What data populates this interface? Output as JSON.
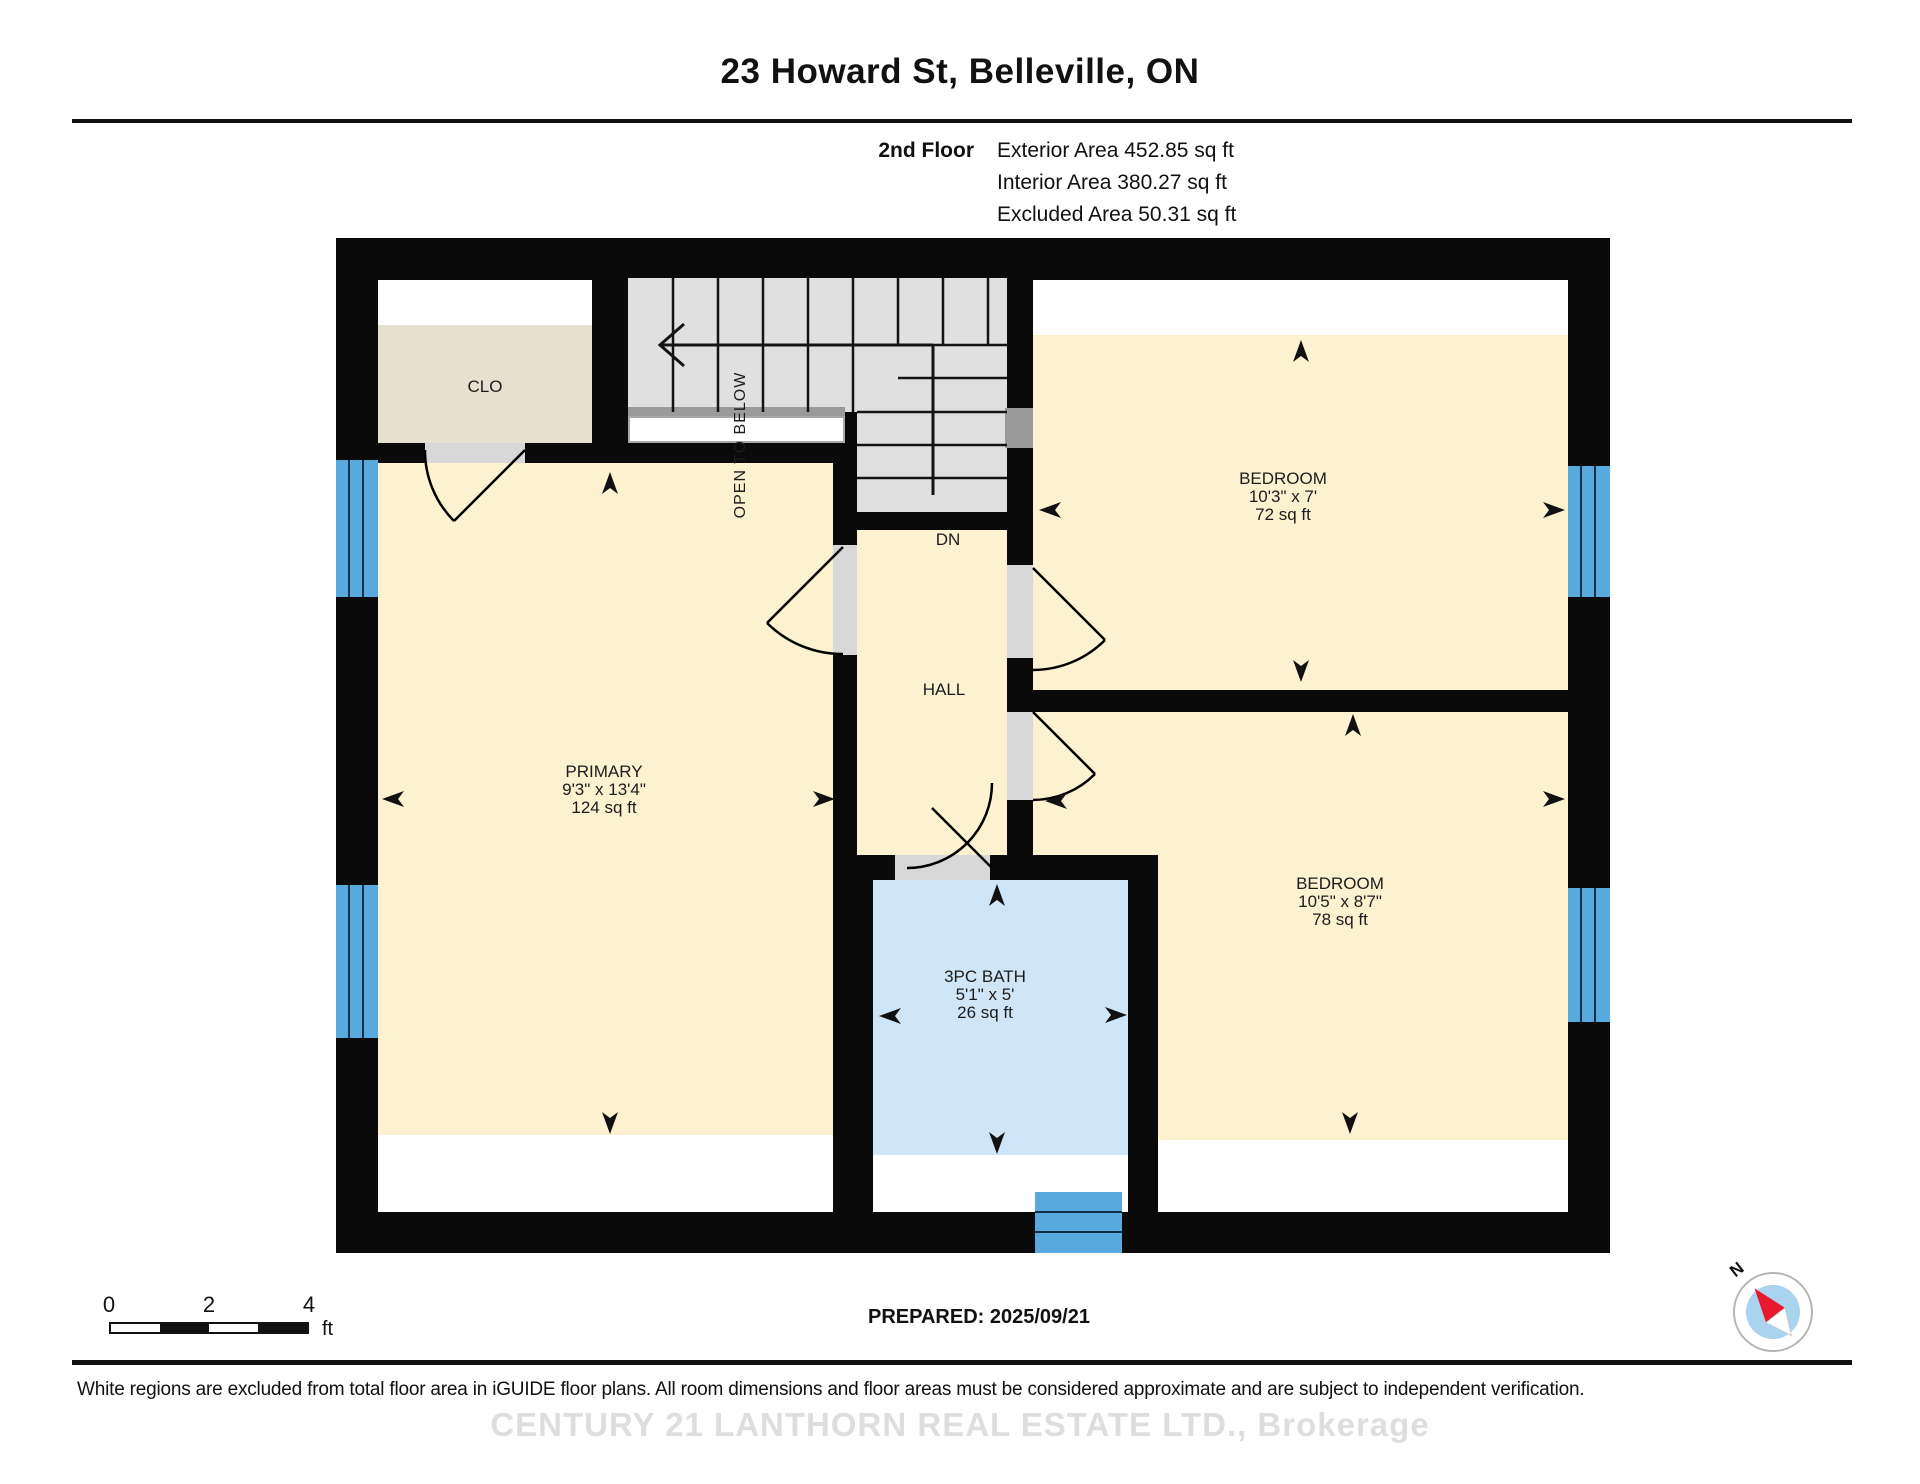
{
  "header": {
    "title": "23 Howard St, Belleville, ON",
    "floor_label": "2nd Floor",
    "areas": [
      "Exterior Area 452.85 sq ft",
      "Interior Area 380.27 sq ft",
      "Excluded Area 50.31 sq ft"
    ]
  },
  "rooms": {
    "closet": {
      "name": "CLO"
    },
    "primary": {
      "name": "PRIMARY",
      "dims": "9'3\" x 13'4\"",
      "area": "124 sq ft"
    },
    "bedroom_top": {
      "name": "BEDROOM",
      "dims": "10'3\" x 7'",
      "area": "72 sq ft"
    },
    "bedroom_bottom": {
      "name": "BEDROOM",
      "dims": "10'5\" x 8'7\"",
      "area": "78 sq ft"
    },
    "bath": {
      "name": "3PC BATH",
      "dims": "5'1\" x 5'",
      "area": "26 sq ft"
    },
    "hall": {
      "name": "HALL"
    },
    "stairs": {
      "down_label": "DN",
      "open_below_label": "OPEN TO BELOW"
    }
  },
  "scalebar": {
    "ticks": [
      "0",
      "2",
      "4"
    ],
    "unit": "ft"
  },
  "compass": {
    "north_label": "N"
  },
  "footer": {
    "prepared": "PREPARED: 2025/09/21",
    "disclaimer": "White regions are excluded from total floor area in iGUIDE floor plans. All room dimensions and floor areas must be considered approximate and are subject to independent verification.",
    "watermark": "CENTURY 21 LANTHORN REAL ESTATE LTD., Brokerage"
  },
  "colors": {
    "room_fill": "#fcf2d0",
    "closet_fill": "#e7dfcf",
    "bath_fill": "#cfe6f8",
    "window_fill": "#58a9dd",
    "stair_fill": "#e0e0e0",
    "wall_color": "#0a0a0a",
    "railing_color": "#9a9a9a",
    "needle_red": "#e8192c",
    "compass_blue": "#a9d3ee"
  }
}
